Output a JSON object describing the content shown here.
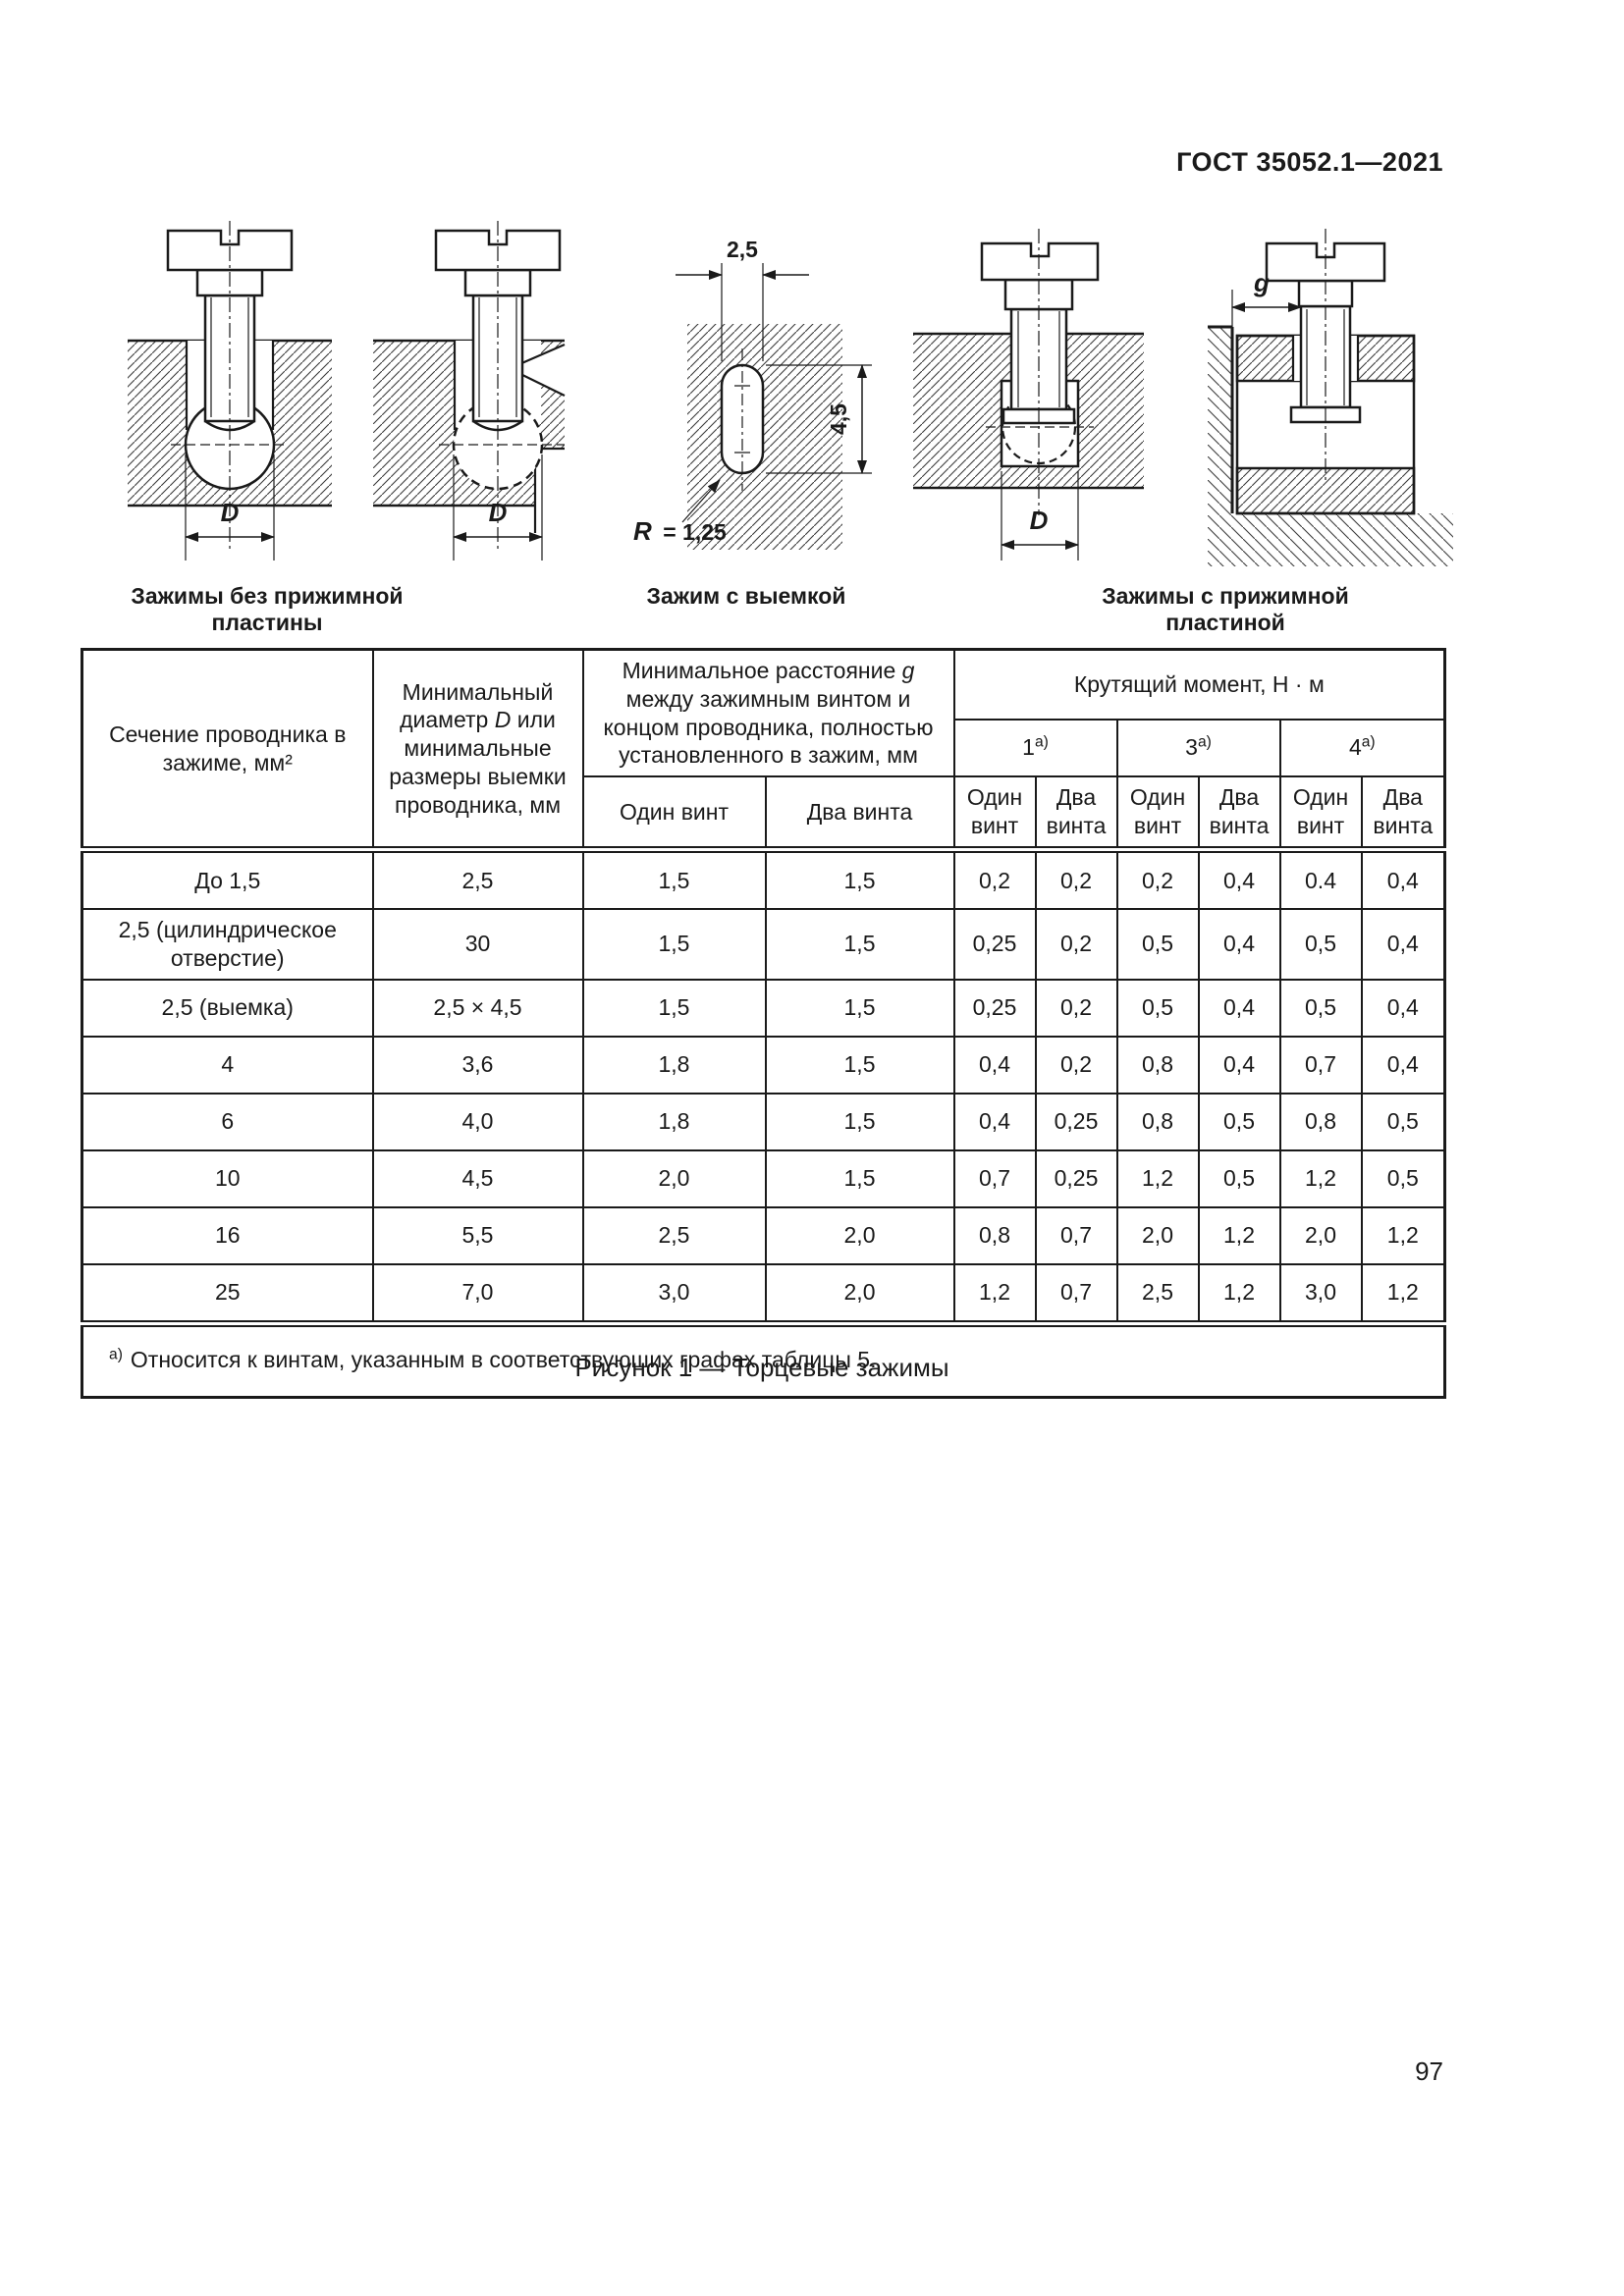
{
  "page": {
    "header": "ГОСТ 35052.1—2021",
    "page_number": "97",
    "figure_caption": "Рисунок 1 — Торцевые зажимы"
  },
  "drawings": {
    "captions": {
      "left": "Зажимы без прижимной пластины",
      "center": "Зажим с выемкой",
      "right": "Зажимы с прижимной пластиной"
    },
    "labels": {
      "diameter": "D",
      "slot_width": "2,5",
      "slot_height": "4,5",
      "radius_var": "R",
      "radius_value": "= 1,25",
      "gap": "g"
    }
  },
  "table": {
    "col1_header": "Сечение проводника в зажиме, мм²",
    "col2_header": {
      "pre": "Минимальный диаметр ",
      "var": "D",
      "post": " или минимальные размеры выемки проводника, мм"
    },
    "g_group": {
      "pre": "Минимальное расстояние ",
      "var": "g",
      "post": " между зажимным винтом и концом проводника, полностью установленного в зажим, мм"
    },
    "one_screw": "Один винт",
    "two_screws": "Два винта",
    "torque_header": "Крутящий момент, Н · м",
    "torque_groups": [
      {
        "num": "1",
        "sup": "а)"
      },
      {
        "num": "3",
        "sup": "а)"
      },
      {
        "num": "4",
        "sup": "а)"
      }
    ],
    "rows": [
      {
        "c": [
          "До 1,5",
          "2,5",
          "1,5",
          "1,5",
          "0,2",
          "0,2",
          "0,2",
          "0,4",
          "0.4",
          "0,4"
        ]
      },
      {
        "c": [
          "2,5 (цилиндрическое отверстие)",
          "30",
          "1,5",
          "1,5",
          "0,25",
          "0,2",
          "0,5",
          "0,4",
          "0,5",
          "0,4"
        ]
      },
      {
        "c": [
          "2,5 (выемка)",
          "2,5 × 4,5",
          "1,5",
          "1,5",
          "0,25",
          "0,2",
          "0,5",
          "0,4",
          "0,5",
          "0,4"
        ]
      },
      {
        "c": [
          "4",
          "3,6",
          "1,8",
          "1,5",
          "0,4",
          "0,2",
          "0,8",
          "0,4",
          "0,7",
          "0,4"
        ]
      },
      {
        "c": [
          "6",
          "4,0",
          "1,8",
          "1,5",
          "0,4",
          "0,25",
          "0,8",
          "0,5",
          "0,8",
          "0,5"
        ]
      },
      {
        "c": [
          "10",
          "4,5",
          "2,0",
          "1,5",
          "0,7",
          "0,25",
          "1,2",
          "0,5",
          "1,2",
          "0,5"
        ]
      },
      {
        "c": [
          "16",
          "5,5",
          "2,5",
          "2,0",
          "0,8",
          "0,7",
          "2,0",
          "1,2",
          "2,0",
          "1,2"
        ]
      },
      {
        "c": [
          "25",
          "7,0",
          "3,0",
          "2,0",
          "1,2",
          "0,7",
          "2,5",
          "1,2",
          "3,0",
          "1,2"
        ]
      }
    ],
    "footnote": {
      "marker": "а)",
      "text": "Относится к винтам, указанным в соответствующих графах таблицы 5."
    }
  }
}
